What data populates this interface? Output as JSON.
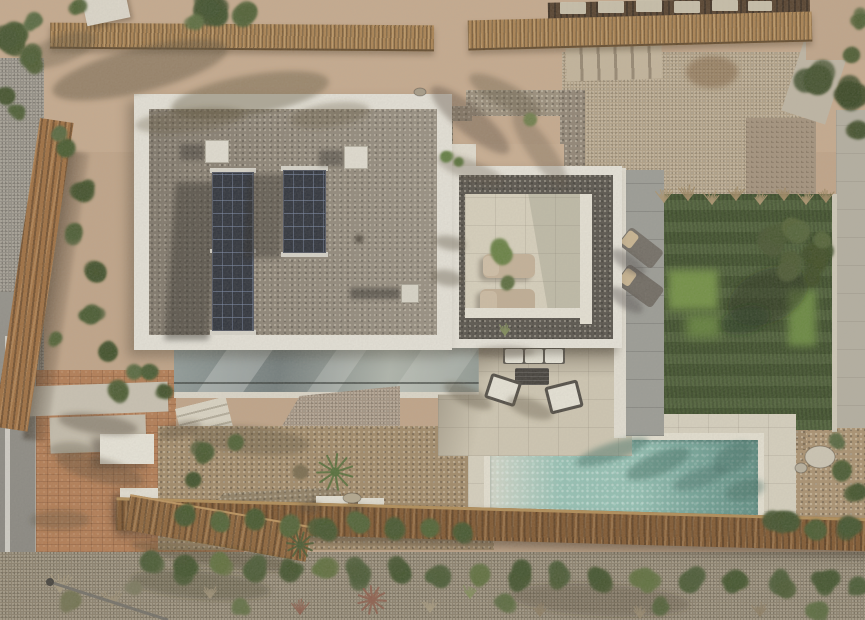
{
  "meta": {
    "domain": "Natural-Image",
    "type": "aerial-drone-photograph",
    "view": "top-down",
    "subject": "modern Mediterranean villa with flat gravel roof, solar panels, roof terrace, lawn, garden and lap pool",
    "lighting": "sunny daytime, sun from upper right, shadows cast to lower-left",
    "has_text": false
  },
  "palette": {
    "sand": "#c6a98c",
    "neighbor_gravel": "#b1a085",
    "roof_white": "#e7e4da",
    "roof_gravel": "#8a8173",
    "terrace_gravel": "#514d46",
    "solar_panel": "#262b35",
    "terrace_tile": "#d8d1bd",
    "patio_tile": "#cfc7b2",
    "pool_deck": "#d7d1bf",
    "pool_water": "#8fc0b3",
    "pool_shallow": "#d3d8ca",
    "pool_deep": "#74a89c",
    "lawn": "#3f5429",
    "lawn_sunlit": "#6d8d3e",
    "stone_path": "#999a94",
    "terracotta_paving": "#b2794f",
    "asphalt_road": "#8b8982",
    "road_line": "#d7d5cd",
    "wood_fence": "#7c5229",
    "reed_fence": "#a87f4c",
    "scrub": "#887d69",
    "shrub_green": "#3f5029",
    "olive_tree": "#41502a"
  },
  "scene": {
    "road": {
      "label": "asphalt road with white edge line",
      "position": "left edge"
    },
    "driveway": {
      "label": "terracotta brick paved driveway with concrete pads and two white entrance canopies",
      "position": "bottom left"
    },
    "main_roof": {
      "label": "flat villa roof, white parapet frame filled with grey gravel",
      "skylight_boxes": 2,
      "vent_box": 1,
      "solar_panels": {
        "groups": 2,
        "modules_per_group": [
          4,
          2
        ],
        "orientation": "vertical strips"
      }
    },
    "roof_terrace": {
      "label": "lower roof terrace framed in white with dark gravel border and cream tiled deck",
      "sun_loungers": 2,
      "lounger_color": "beige"
    },
    "side_path": {
      "label": "grey stone path with two dark sun loungers with beige pillows",
      "position": "right of roof terrace"
    },
    "lawn": {
      "label": "artificial lawn with olive tree and ornamental grass fringe",
      "position": "right"
    },
    "patio": {
      "label": "cream tiled patio with outdoor sofa (3 white cushions), dark coffee table and two white armchairs",
      "position": "center below house"
    },
    "pool": {
      "label": "rectangular lap pool, turquoise water, beach-entry lighter at left end, white coping and cream deck",
      "position": "bottom center-right"
    },
    "glass_facade": {
      "label": "lower floor glass wall with diagonal sky reflections",
      "position": "below main roof"
    },
    "stone_features": [
      "dry-stone wedge wall at house base",
      "rubble wall in garden",
      "stone boundary walls of neighbour plot",
      "stone stairway top-right"
    ],
    "stairs": {
      "exterior_white_stairs": 2
    },
    "fences": [
      "reed fence along top boundary",
      "long wooden slat fence across bottom",
      "wooden retaining wall diagonal on left",
      "wooden walkway bottom left"
    ],
    "garden": {
      "label": "gravel garden with palm, shrubs and hedges; Mediterranean scrub strip at bottom",
      "white_utility_boxes": 2
    },
    "street_lamp": {
      "label": "street lamp seen from above",
      "position": "bottom left on road"
    },
    "neighbour_plot": {
      "label": "gravel yard with stepping stones, stone steps and concrete path",
      "position": "top right"
    }
  },
  "decor": {
    "veg": [
      [
        12,
        42,
        16,
        "#3f5029",
        6
      ],
      [
        30,
        58,
        13,
        "#46582e",
        5
      ],
      [
        6,
        96,
        11,
        "#3c4d27",
        4
      ],
      [
        18,
        112,
        9,
        "#46582e",
        3
      ],
      [
        34,
        20,
        10,
        "#52653a",
        3
      ],
      [
        210,
        10,
        20,
        "#3b4c26",
        7
      ],
      [
        243,
        16,
        14,
        "#4a5c2f",
        5
      ],
      [
        196,
        22,
        10,
        "#55683a",
        3
      ],
      [
        80,
        6,
        9,
        "#4a5c2f",
        3
      ],
      [
        818,
        80,
        18,
        "#3c4c28",
        6
      ],
      [
        848,
        95,
        16,
        "#34431f",
        5
      ],
      [
        858,
        130,
        12,
        "#3c4c28",
        4
      ],
      [
        852,
        55,
        10,
        "#46572c",
        3
      ],
      [
        862,
        20,
        9,
        "#4a5c2f",
        3
      ],
      [
        66,
        148,
        12,
        "#42552a",
        4
      ],
      [
        84,
        192,
        13,
        "#3a4b24",
        5
      ],
      [
        74,
        232,
        11,
        "#46572c",
        4
      ],
      [
        96,
        272,
        13,
        "#3a4b24",
        5
      ],
      [
        92,
        314,
        12,
        "#42552a",
        4
      ],
      [
        108,
        352,
        12,
        "#3a4b24",
        4
      ],
      [
        118,
        390,
        13,
        "#46572c",
        5
      ],
      [
        134,
        372,
        10,
        "#52643a",
        3
      ],
      [
        60,
        134,
        9,
        "#52643a",
        3
      ],
      [
        56,
        338,
        8,
        "#4a5c2f",
        3
      ],
      [
        446,
        157,
        7,
        "#5d7a3c",
        3
      ],
      [
        459,
        162,
        6,
        "#526d34",
        3
      ],
      [
        500,
        252,
        12,
        "#647d3e",
        5
      ],
      [
        508,
        282,
        8,
        "#56693a",
        3
      ],
      [
        530,
        120,
        8,
        "#6b7b46",
        3
      ],
      [
        205,
        452,
        12,
        "#42552a",
        4
      ],
      [
        236,
        442,
        10,
        "#4a5c2f",
        3
      ],
      [
        300,
        472,
        9,
        "#76684a",
        3
      ],
      [
        193,
        480,
        10,
        "#3a4b24",
        3
      ],
      [
        150,
        372,
        10,
        "#42552a",
        4
      ],
      [
        166,
        392,
        9,
        "#3a4b24",
        3
      ],
      [
        185,
        516,
        13,
        "#3f5228",
        4
      ],
      [
        220,
        522,
        12,
        "#4b5e30",
        4
      ],
      [
        255,
        520,
        13,
        "#3f5228",
        4
      ],
      [
        290,
        526,
        12,
        "#4b5e30",
        4
      ],
      [
        325,
        528,
        13,
        "#3f5228",
        4
      ],
      [
        360,
        524,
        12,
        "#4b5e30",
        4
      ],
      [
        395,
        530,
        13,
        "#3f5228",
        4
      ],
      [
        430,
        528,
        12,
        "#4b5e30",
        4
      ],
      [
        462,
        532,
        12,
        "#3f5228",
        4
      ],
      [
        782,
        522,
        14,
        "#3c4e27",
        5
      ],
      [
        816,
        530,
        13,
        "#44562c",
        4
      ],
      [
        848,
        526,
        13,
        "#3c4e27",
        4
      ],
      [
        842,
        470,
        12,
        "#44562c",
        4
      ],
      [
        858,
        492,
        11,
        "#3c4e27",
        4
      ],
      [
        836,
        440,
        9,
        "#50623a",
        3
      ],
      [
        150,
        562,
        13,
        "#44552e",
        4
      ],
      [
        185,
        566,
        14,
        "#3c4e27",
        4
      ],
      [
        220,
        564,
        12,
        "#5a6b38",
        4
      ],
      [
        255,
        570,
        14,
        "#44552e",
        4
      ],
      [
        290,
        572,
        13,
        "#3c4e27",
        4
      ],
      [
        325,
        568,
        13,
        "#5a6b38",
        4
      ],
      [
        360,
        574,
        14,
        "#44552e",
        4
      ],
      [
        400,
        572,
        13,
        "#3c4e27",
        4
      ],
      [
        440,
        576,
        14,
        "#44552e",
        4
      ],
      [
        480,
        574,
        13,
        "#5a6b38",
        4
      ],
      [
        520,
        578,
        14,
        "#3c4e27",
        4
      ],
      [
        560,
        576,
        13,
        "#44552e",
        4
      ],
      [
        600,
        580,
        14,
        "#3c4e27",
        4
      ],
      [
        645,
        578,
        13,
        "#5a6b38",
        4
      ],
      [
        690,
        582,
        14,
        "#44552e",
        4
      ],
      [
        735,
        580,
        13,
        "#3c4e27",
        4
      ],
      [
        780,
        584,
        14,
        "#44552e",
        4
      ],
      [
        825,
        582,
        13,
        "#3c4e27",
        4
      ],
      [
        858,
        586,
        12,
        "#44552e",
        3
      ],
      [
        70,
        600,
        12,
        "#6e6f4c",
        4
      ],
      [
        240,
        606,
        10,
        "#5d6b3f",
        3
      ],
      [
        505,
        602,
        11,
        "#55663a",
        4
      ],
      [
        660,
        608,
        10,
        "#4c5c33",
        3
      ],
      [
        820,
        610,
        11,
        "#55663a",
        3
      ],
      [
        135,
        588,
        9,
        "#77755a",
        3
      ],
      [
        770,
        240,
        16,
        "#41502a",
        6
      ],
      [
        798,
        232,
        15,
        "#4d5e31",
        6
      ],
      [
        815,
        255,
        16,
        "#37461f",
        6
      ],
      [
        790,
        268,
        14,
        "#45542c",
        5
      ],
      [
        812,
        278,
        11,
        "#37461f",
        4
      ],
      [
        822,
        240,
        10,
        "#4d5e31",
        4
      ]
    ],
    "grass": [
      [
        664,
        202,
        13,
        "#a8916a"
      ],
      [
        688,
        200,
        14,
        "#9c855e"
      ],
      [
        712,
        204,
        13,
        "#a8916a"
      ],
      [
        736,
        200,
        14,
        "#9c855e"
      ],
      [
        760,
        204,
        13,
        "#a8916a"
      ],
      [
        784,
        200,
        13,
        "#9c855e"
      ],
      [
        806,
        204,
        12,
        "#a8916a"
      ],
      [
        826,
        202,
        12,
        "#9c855e"
      ],
      [
        60,
        592,
        18,
        "#a4977b"
      ],
      [
        112,
        606,
        16,
        "#9a8d72"
      ],
      [
        300,
        614,
        14,
        "#8a5a48"
      ],
      [
        372,
        604,
        16,
        "#96604b"
      ],
      [
        430,
        612,
        13,
        "#a4977b"
      ],
      [
        540,
        616,
        12,
        "#8a7a5f"
      ],
      [
        640,
        618,
        12,
        "#93856a"
      ],
      [
        760,
        616,
        13,
        "#8a7a5f"
      ],
      [
        470,
        598,
        13,
        "#7d8a55"
      ],
      [
        505,
        335,
        12,
        "#7d8a55"
      ],
      [
        210,
        598,
        13,
        "#9a8d72"
      ]
    ],
    "shadows": [
      [
        140,
        70,
        90,
        22,
        -14,
        0.45,
        "#564a33"
      ],
      [
        250,
        95,
        80,
        20,
        -10,
        0.4,
        "#564a33"
      ],
      [
        60,
        50,
        38,
        14,
        -20,
        0.35,
        "#564a33"
      ],
      [
        330,
        115,
        40,
        12,
        -8,
        0.3,
        "#564a33"
      ],
      [
        190,
        120,
        55,
        12,
        -6,
        0.3,
        "#564a33"
      ],
      [
        470,
        120,
        50,
        14,
        40,
        0.4,
        "#544734"
      ],
      [
        505,
        95,
        40,
        12,
        28,
        0.35,
        "#544734"
      ],
      [
        540,
        150,
        45,
        12,
        55,
        0.3,
        "#544734"
      ],
      [
        470,
        170,
        35,
        10,
        20,
        0.3,
        "#544734"
      ],
      [
        712,
        72,
        26,
        16,
        0,
        0.5,
        "#7a5a36"
      ],
      [
        768,
        296,
        42,
        26,
        -25,
        0.5,
        "#1f2c12"
      ],
      [
        745,
        320,
        25,
        14,
        -15,
        0.4,
        "#1f2c12"
      ],
      [
        98,
        424,
        40,
        10,
        8,
        0.4,
        "#4a3f2c"
      ],
      [
        70,
        450,
        22,
        8,
        0,
        0.3,
        "#4a3f2c"
      ],
      [
        100,
        470,
        45,
        12,
        15,
        0.35,
        "#4a3f2c"
      ],
      [
        60,
        520,
        30,
        10,
        0,
        0.3,
        "#4a3f2c"
      ],
      [
        215,
        556,
        85,
        10,
        8,
        0.35,
        "#3a3122"
      ],
      [
        250,
        440,
        60,
        14,
        5,
        0.3,
        "#4a3f2a"
      ],
      [
        180,
        430,
        22,
        8,
        -15,
        0.35,
        "#4a3f2c"
      ],
      [
        612,
        452,
        38,
        9,
        -18,
        0.5,
        "#3e6e63"
      ],
      [
        658,
        464,
        34,
        11,
        -22,
        0.5,
        "#39685d"
      ],
      [
        700,
        478,
        28,
        9,
        -20,
        0.45,
        "#3e6e63"
      ],
      [
        733,
        458,
        22,
        13,
        -30,
        0.45,
        "#39685d"
      ],
      [
        745,
        490,
        20,
        10,
        -15,
        0.4,
        "#35645a"
      ],
      [
        468,
        396,
        26,
        9,
        25,
        0.4,
        "#55493a"
      ],
      [
        530,
        408,
        24,
        9,
        20,
        0.38,
        "#55493a"
      ],
      [
        505,
        352,
        30,
        6,
        0,
        0.35,
        "#55493a"
      ],
      [
        450,
        243,
        16,
        7,
        10,
        0.4,
        "#55493a"
      ],
      [
        447,
        278,
        16,
        8,
        10,
        0.4,
        "#55493a"
      ],
      [
        628,
        262,
        20,
        8,
        35,
        0.4,
        "#43423c"
      ],
      [
        626,
        300,
        20,
        8,
        35,
        0.4,
        "#43423c"
      ],
      [
        310,
        508,
        12,
        6,
        0,
        0.35,
        "#4a3f2c"
      ],
      [
        355,
        509,
        10,
        5,
        0,
        0.3,
        "#4a3f2c"
      ],
      [
        200,
        585,
        70,
        14,
        5,
        0.3,
        "#3c3424"
      ],
      [
        600,
        600,
        90,
        16,
        3,
        0.25,
        "#3c3424"
      ]
    ],
    "palms": [
      [
        335,
        472,
        18,
        "#4e6a33"
      ],
      [
        300,
        545,
        13,
        "#44552c"
      ],
      [
        372,
        600,
        14,
        "#8a5a48"
      ]
    ],
    "stones": [
      [
        820,
        457,
        15,
        11,
        "#cdc6b4"
      ],
      [
        801,
        468,
        6,
        5,
        "#b8b09d"
      ],
      [
        352,
        498,
        9,
        5,
        "#b2a68c"
      ],
      [
        420,
        92,
        6,
        4,
        "#a59a85"
      ]
    ],
    "lamp": {
      "x1": 50,
      "y1": 582,
      "x2": 168,
      "y2": 620,
      "head": [
        50,
        582
      ]
    },
    "pavers_top": [
      [
        560,
        2,
        26,
        12
      ],
      [
        598,
        1,
        26,
        12
      ],
      [
        636,
        0,
        26,
        12
      ],
      [
        674,
        1,
        26,
        12
      ],
      [
        712,
        0,
        26,
        11
      ],
      [
        748,
        1,
        24,
        10
      ]
    ]
  }
}
